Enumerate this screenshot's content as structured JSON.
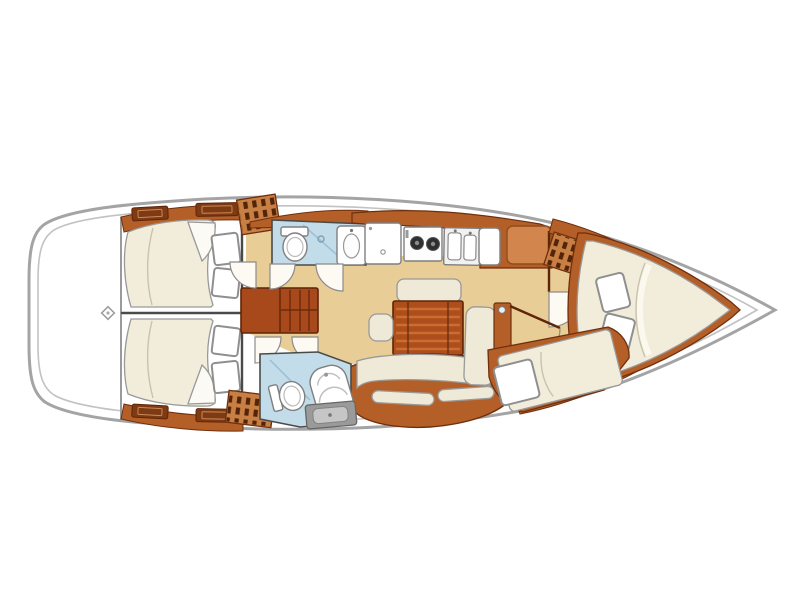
{
  "figure": {
    "description": "Sailing yacht interior layout plan, viewed from above, bow pointing right",
    "diagram_type": "boat-floor-plan"
  },
  "colors": {
    "background": "#ffffff",
    "hull_outline": "#a4a4a4",
    "hull_inner_line": "#c2c2c2",
    "deck": "#ffffff",
    "floor": "#e8cd96",
    "wood": "#b55f28",
    "wood_dark": "#7e3a12",
    "steps": "#a8491b",
    "table": "#ad4f1d",
    "table_stripe": "#cd6c30",
    "bed": "#f2ecdb",
    "cushion": "#efe9d8",
    "pillow": "#ffffff",
    "head_floor": "#c2dcea",
    "shower_glass": "#9fc0d4",
    "appliance": "#ffffff",
    "sink_steel": "#f1f1f1",
    "burner": "#2f2f2f",
    "louver_base": "#c87f43",
    "louver_slat": "#53240a",
    "shower_box": "#9a9a9a",
    "shower_box_inner": "#c6c6c6",
    "nav_desk": "#d2854c"
  },
  "layout_inventory": {
    "stern": [
      "stern-platform",
      "stern-fitting"
    ],
    "aft_cabin_port": [
      "double-berth",
      "sheet-fold",
      "pillow x2",
      "shelf-with-drawers",
      "louvered-locker",
      "cabin-door"
    ],
    "aft_cabin_starboard": [
      "double-berth",
      "sheet-fold",
      "pillow x2",
      "shelf-with-drawers",
      "louvered-locker",
      "cabin-door"
    ],
    "companionway": [
      "steps"
    ],
    "head_forward": [
      "toilet",
      "washbasin",
      "shower-glass",
      "door"
    ],
    "galley": [
      "refrigerator-top-load",
      "stove-two-burner",
      "double-sink",
      "counter"
    ],
    "nav_station": [
      "chart-table-white",
      "desk-panel",
      "partition",
      "door"
    ],
    "salon": [
      "folding-table",
      "bench-seat",
      "stool",
      "l-settee",
      "cushions x4",
      "backrest-panel"
    ],
    "head_aft": [
      "toilet",
      "washbasin-column",
      "shower-tray",
      "door"
    ],
    "forward_cabin": [
      "island-double-berth",
      "sheet-fold",
      "pillow x2",
      "louvered-locker",
      "sofa-berth",
      "sofa-pillow",
      "door"
    ]
  }
}
